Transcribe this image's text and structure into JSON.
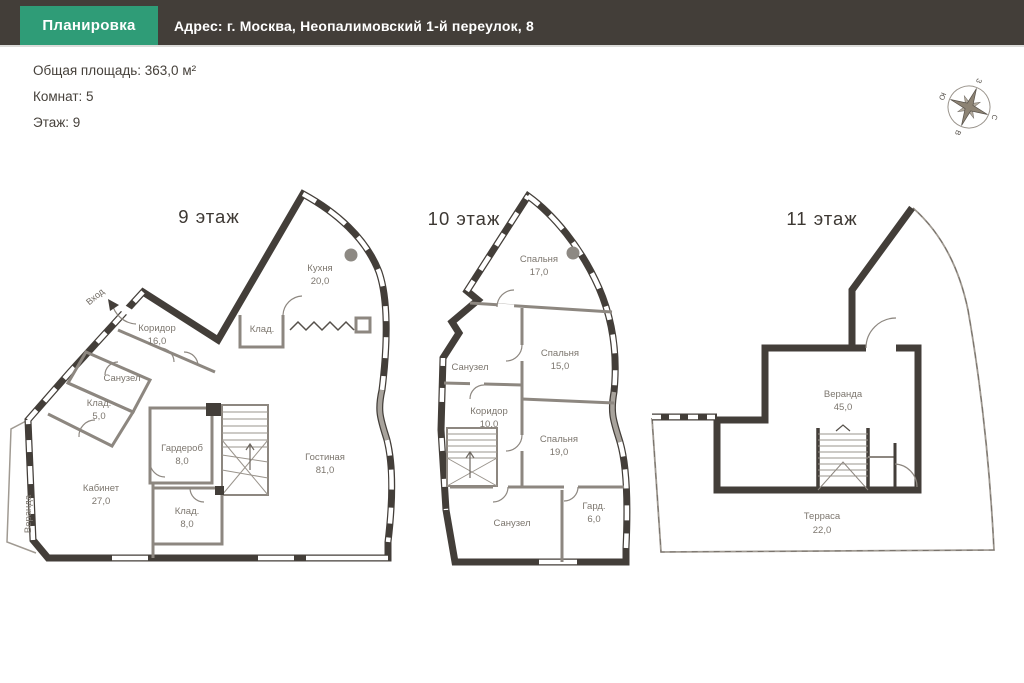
{
  "header": {
    "tab_label": "Планировка",
    "address": "Адрес: г. Москва, Неопалимовский 1-й переулок, 8"
  },
  "info": {
    "total_area": "Общая площадь: 363,0 м²",
    "rooms_count": "Комнат: 5",
    "floor": "Этаж: 9"
  },
  "compass": {
    "north": "С",
    "east": "В",
    "south": "Ю",
    "west": "З"
  },
  "entrance_label": "Вход",
  "floors": [
    {
      "title": "9 этаж",
      "rooms": [
        {
          "name": "Кухня",
          "area": "20,0"
        },
        {
          "name": "Клад.",
          "area": ""
        },
        {
          "name": "Коридор",
          "area": "16,0"
        },
        {
          "name": "Санузел",
          "area": ""
        },
        {
          "name": "Клад.",
          "area": "5,0"
        },
        {
          "name": "Гардероб",
          "area": "8,0"
        },
        {
          "name": "Кабинет",
          "area": "27,0"
        },
        {
          "name": "Клад.",
          "area": "8,0"
        },
        {
          "name": "Гостиная",
          "area": "81,0"
        },
        {
          "name": "Веранда",
          "area": ""
        }
      ]
    },
    {
      "title": "10 этаж",
      "rooms": [
        {
          "name": "Спальня",
          "area": "17,0"
        },
        {
          "name": "Санузел",
          "area": ""
        },
        {
          "name": "Спальня",
          "area": "15,0"
        },
        {
          "name": "Коридор",
          "area": "10,0"
        },
        {
          "name": "Спальня",
          "area": "19,0"
        },
        {
          "name": "Санузел",
          "area": ""
        },
        {
          "name": "Гард.",
          "area": "6,0"
        }
      ]
    },
    {
      "title": "11 этаж",
      "rooms": [
        {
          "name": "Веранда",
          "area": "45,0"
        },
        {
          "name": "Терраса",
          "area": "22,0"
        }
      ]
    }
  ],
  "colors": {
    "header_bg": "#433e39",
    "accent_green": "#2f9c77",
    "wall": "#433e39",
    "interior_wall": "#8d8780",
    "label_text": "#7c766e"
  }
}
